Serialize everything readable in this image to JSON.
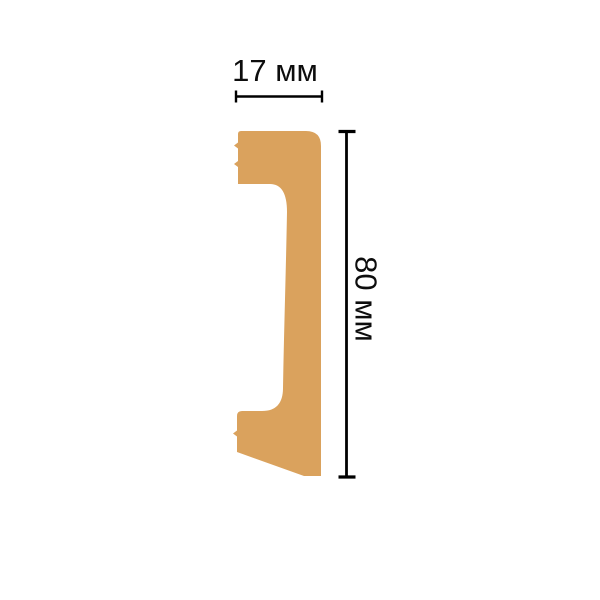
{
  "diagram": {
    "kind": "molding-profile-cross-section",
    "width_label": "17 мм",
    "height_label": "80 мм",
    "width_value_mm": 17,
    "height_value_mm": 80,
    "unit": "мм",
    "profile_color": "#DAA25D",
    "line_color": "#000000",
    "background_color": "#FFFFFF"
  }
}
